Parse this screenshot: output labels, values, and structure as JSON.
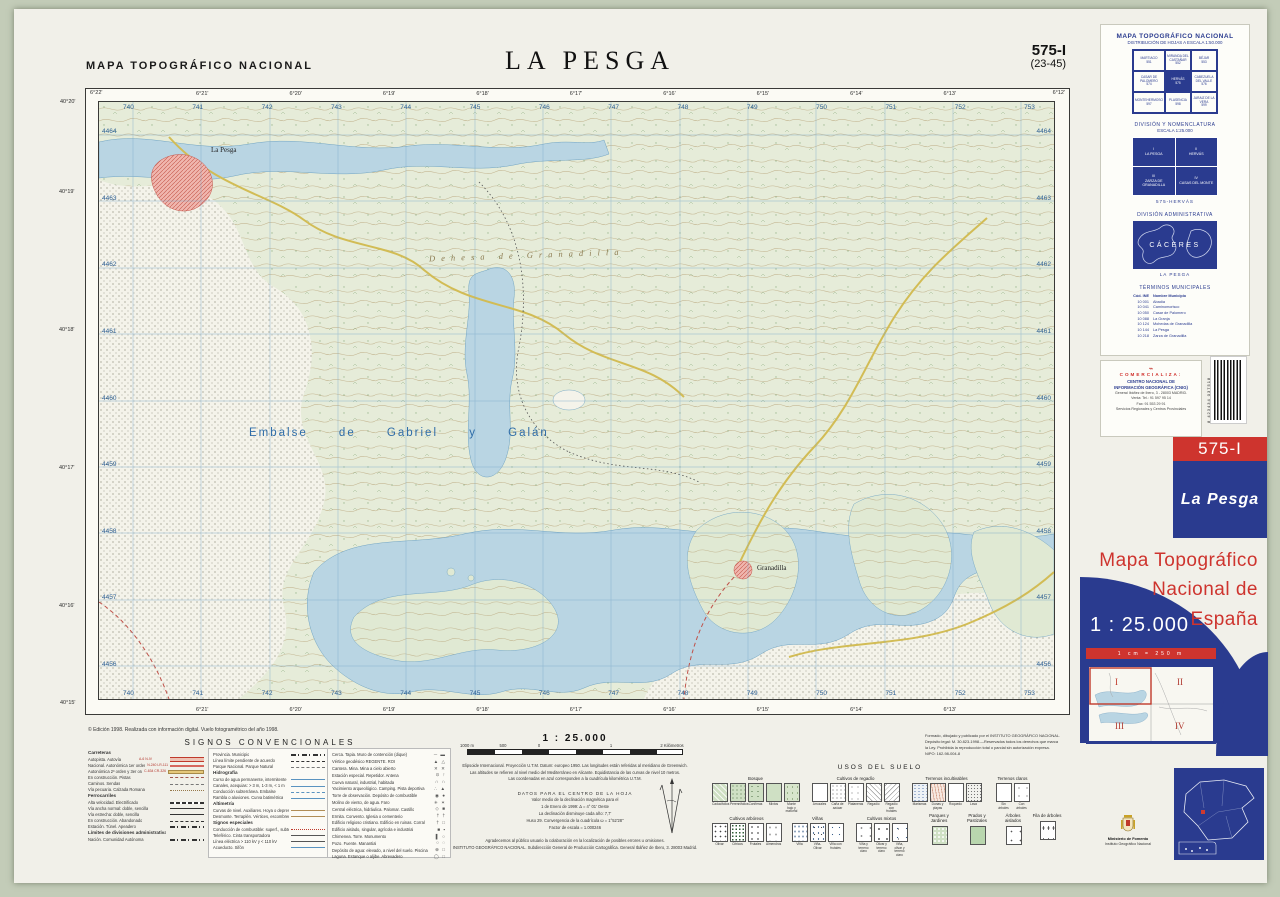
{
  "header": {
    "series": "MAPA TOPOGRÁFICO NACIONAL",
    "title": "LA PESGA",
    "sheet": "575-I",
    "subsheet": "(23-45)"
  },
  "map": {
    "labels": {
      "reservoir": "Embalse de Gabriel y Galán",
      "dehesa": "Dehesa de Granadilla",
      "town1": "La Pesga",
      "town2": "Granadilla"
    },
    "edges": {
      "eastings": [
        "740",
        "741",
        "742",
        "743",
        "744",
        "745",
        "746",
        "747",
        "748",
        "749",
        "750",
        "751",
        "752",
        "753"
      ],
      "northings": [
        "4464",
        "4463",
        "4462",
        "4461",
        "4460",
        "4459",
        "4458",
        "4457",
        "4456"
      ],
      "lon_ticks": [
        "6°21'",
        "6°20'",
        "6°19'",
        "6°18'",
        "6°17'",
        "6°16'",
        "6°15'",
        "6°14'",
        "6°13'"
      ],
      "lat_ticks": [
        "40°19'",
        "40°18'",
        "40°17'",
        "40°16'"
      ],
      "corner_lat_top": "40°20'",
      "corner_lat_bottom": "40°15'",
      "corner_lon_left": "6°22'",
      "corner_lon_right": "6°12'"
    }
  },
  "sidebar": {
    "dist": {
      "title": "MAPA TOPOGRÁFICO NACIONAL",
      "subtitle": "DISTRIBUCIÓN DE HOJAS A ESCALA 1:50.000",
      "cells": [
        {
          "name": "MARTIAGO",
          "num": "551"
        },
        {
          "name": "MIRANDA DEL CASTAÑAR",
          "num": "552"
        },
        {
          "name": "BÉJAR",
          "num": "553"
        },
        {
          "name": "CASAR DE PALOMERO",
          "num": "574"
        },
        {
          "name": "HERVÁS",
          "num": "575"
        },
        {
          "name": "CABEZUELA DEL VALLE",
          "num": "576"
        },
        {
          "name": "MONTEHERMOSO",
          "num": "597"
        },
        {
          "name": "PLASENCIA",
          "num": "598"
        },
        {
          "name": "JARAIZ DE LA VERA",
          "num": "599"
        }
      ]
    },
    "nomen": {
      "title": "DIVISIÓN Y NOMENCLATURA",
      "subtitle": "ESCALA 1:25.000",
      "cells": [
        {
          "rn": "I",
          "name": "LA PESGA"
        },
        {
          "rn": "II",
          "name": "HERVÁS"
        },
        {
          "rn": "III",
          "name": "ZARZA DE GRANADILLA"
        },
        {
          "rn": "IV",
          "name": "CASAS DEL MONTE"
        }
      ],
      "caption": "575-HERVÁS"
    },
    "admin": {
      "title": "DIVISIÓN ADMINISTRATIVA",
      "region": "CÁCERES",
      "caption": "LA PESGA"
    },
    "municipios": {
      "title": "TÉRMINOS MUNICIPALES",
      "header": {
        "c": "Cód. INE",
        "n": "Nombre Municipio"
      },
      "rows": [
        {
          "c": "10 001",
          "n": "Abadía"
        },
        {
          "c": "10 041",
          "n": "Caminomorisco"
        },
        {
          "c": "10 050",
          "n": "Casar de Palomero"
        },
        {
          "c": "10 088",
          "n": "La Granja"
        },
        {
          "c": "10 124",
          "n": "Mohedas de Granadilla"
        },
        {
          "c": "10 144",
          "n": "La Pesga"
        },
        {
          "c": "10 218",
          "n": "Zarza de Granadilla"
        }
      ]
    },
    "comercializa": {
      "label": "COMERCIALIZA:",
      "org1": "CENTRO NACIONAL DE",
      "org2": "INFORMACIÓN GEOGRÁFICA (CNIG)",
      "addr": "General Ibáñez de Ibero, 3 - 28003 MADRID.",
      "tel": "Venta: Tel.: 91 597 95 14",
      "fax": "Fax: 91 553 29 91",
      "services": "Servicios Regionales y Centros Provinciales"
    },
    "barcode": "8 423434 037518"
  },
  "cover": {
    "sheet": "575-I",
    "name": "La Pesga",
    "title1": "Mapa  Topográfico",
    "title2": "Nacional de",
    "title3": "España",
    "scale": "1 : 25.000",
    "bar": "1 cm = 250 m",
    "quads": [
      "I",
      "II",
      "III",
      "IV"
    ]
  },
  "ministry": {
    "l1": "Ministerio de Fomento",
    "l2": "Instituto Geográfico Nacional"
  },
  "legend": {
    "edition": "© Edición 1998. Realizada con información digital. Vuelo fotogramétrico del año 1998.",
    "title": "SIGNOS CONVENCIONALES",
    "c1": [
      {
        "t": "Carreteras",
        "rc": "lhdr",
        "sc": "sR"
      },
      {
        "t": "Autopista. Autovía",
        "bt": "A-6   N-IV",
        "sc": "sA"
      },
      {
        "t": "Nacional. Autonómica 1er orden",
        "bt": "N-240   LR-111",
        "sc": "sB"
      },
      {
        "t": "Autonómica 2º orden y 3er orden y otras",
        "bt": "C-634   CR-326",
        "sc": "sC"
      },
      {
        "t": "En construcción. Pistas",
        "sc": "sD"
      },
      {
        "t": "Caminos. Sendas",
        "sc": "sF"
      },
      {
        "t": "Vía pecuaria. Calzada Romana",
        "sc": "sG"
      },
      {
        "t": "Ferrocarriles",
        "rc": "lhdr",
        "sc": "sR"
      },
      {
        "t": "Alta velocidad. Electrificado",
        "sc": "sH"
      },
      {
        "t": "Vía ancha normal: doble, sencilla",
        "sc": "sI"
      },
      {
        "t": "Vía estrecha: doble, sencilla",
        "sc": "sI"
      },
      {
        "t": "En construcción. Abandonado",
        "sc": "sJ"
      },
      {
        "t": "Estación. Túnel. Apeadero",
        "sc": "sK"
      },
      {
        "t": "Límites de divisiones administrativas",
        "rc": "lhdr",
        "sc": "sR"
      },
      {
        "t": "Nación. Comunidad Autónoma",
        "sc": "sK"
      }
    ],
    "c2": [
      {
        "t": "Provincia. Municipio",
        "sc": "sK"
      },
      {
        "t": "Línea límite pendiente de acuerdo",
        "sc": "sJ"
      },
      {
        "t": "Parque Nacional. Parque Natural",
        "sc": "sF"
      },
      {
        "t": "Hidrografía",
        "rc": "lhdr",
        "sc": "sR"
      },
      {
        "t": "Curso de agua permanente, intermitente",
        "sc": "sL"
      },
      {
        "t": "Canales, acequias: > 3 m, 1-3 m, < 1 m",
        "sc": "sM"
      },
      {
        "t": "Conducción subterránea. Embalse",
        "sc": "sN"
      },
      {
        "t": "Rambla o aluviones. Curva batimétrica",
        "sc": "sL"
      },
      {
        "t": "Altimetría",
        "rc": "lhdr",
        "sc": "sR"
      },
      {
        "t": "Curvas de nivel. Auxiliares. Hoya o depresión",
        "sc": "sO"
      },
      {
        "t": "Desmonte. Terraplén. Vértices, escombrera",
        "sc": "sO"
      },
      {
        "t": "Signos especiales",
        "rc": "lhdr",
        "sc": "sR"
      },
      {
        "t": "Conducción de combustible: superf., subterr.",
        "sc": "sQ"
      },
      {
        "t": "Teleférico. Cinta transportadora",
        "sc": "sP"
      },
      {
        "t": "Línea eléctrica > 110 kV y < 110 kV",
        "sc": "sP"
      },
      {
        "t": "Acueducto. Sifón",
        "sc": "sL"
      }
    ],
    "c3": [
      {
        "t": "Cerca. Tapia. Muro de contención (dique)",
        "g": "─  ▬"
      },
      {
        "t": "Vértice geodésico REGENTE. ROI",
        "g": "▲  △"
      },
      {
        "t": "Cantera. Mina. Mina a cielo abierto",
        "g": "✕  ✕"
      },
      {
        "t": "Estación especial. Repetidor. Antena",
        "g": "⊙  ↑"
      },
      {
        "t": "Cueva natural, industrial, habitada",
        "g": "∩  ∩"
      },
      {
        "t": "Yacimiento arqueológico. Camping. Pista deportiva",
        "g": "∴  ▲"
      },
      {
        "t": "Torre de observación. Depósito de combustible",
        "g": "◉  ●"
      },
      {
        "t": "Molino de viento, de agua. Faro",
        "g": "✳  ✶"
      },
      {
        "t": "Central eléctrica, hidráulica. Palomar. Castillo",
        "g": "◇  ■"
      },
      {
        "t": "Ermita. Convento. Iglesia o cementerio",
        "g": "†  †"
      },
      {
        "t": "Edificio religioso cristiano. Edificio en ruinas. Corral",
        "g": "†  □"
      },
      {
        "t": "Edificio aislado, singular, agrícola e industrial",
        "g": "■  ▪"
      },
      {
        "t": "Chimenea. Torre. Monumento",
        "g": "▌  ○"
      },
      {
        "t": "Pozo. Fuente. Manantial",
        "g": "○  ◌"
      },
      {
        "t": "Depósito de agua: elevado, a nivel del suelo. Piscina",
        "g": "⊕  □"
      },
      {
        "t": "Laguna. Estanque o aljibe. Abrevadero",
        "g": "◯  □"
      }
    ]
  },
  "scaleblock": {
    "title": "1 : 25.000",
    "bar_labels": [
      "1000 m",
      "500",
      "0",
      "1",
      "2 Kilómetros"
    ],
    "proj": [
      "Elipsoide Internacional. Proyección U.T.M. Datum: europeo 1950. Las longitudes están referidas al meridiano de Greenwich.",
      "Las altitudes se refieren al nivel medio del Mediterráneo en Alicante. Equidistancia de las curvas de nivel 10 metros.",
      "Las coordenadas en azul corresponden a la cuadrícula kilométrica U.T.M."
    ],
    "datos": [
      "DATOS PARA EL CENTRO DE LA HOJA",
      "Valor medio de la declinación magnética para el",
      "1 de Enero de 1999:  Δ = 4° 01' Oeste",
      "La declinación disminuye cada año: 7,7'",
      "Huso 29. Convergencia de la cuadrícula ω = 1°52'28\"",
      "Factor de escala  =  1.000246"
    ],
    "ack": [
      "Agradecemos al público usuario la colaboración en la localización de posibles errores u omisiones.",
      "INSTITUTO GEOGRÁFICO NACIONAL. Subdirección General de Producción Cartográfica. General Ibáñez de Ibero, 3. 28003 Madrid."
    ]
  },
  "publisher": [
    "Formado, dibujado y publicado por el INSTITUTO GEOGRÁFICO NACIONAL.",
    "Depósito legal: M. 30.823-1998.—Reservados todos los derechos que marca",
    "la Ley. Prohibida la reproducción total o parcial sin autorización expresa.",
    "NIPO: 162-98-004-8"
  ],
  "usos": {
    "title": "USOS DEL SUELO",
    "groups": [
      {
        "title": "Bosque",
        "items": [
          {
            "label": "Caducifolios",
            "cls": "b1"
          },
          {
            "label": "Perennifolios",
            "cls": "b2"
          },
          {
            "label": "Coníferas",
            "cls": "b3"
          },
          {
            "label": "Mixtos",
            "cls": "b4"
          },
          {
            "label": "Monte bajo y matorral",
            "cls": "b5"
          }
        ]
      },
      {
        "title": "Cultivos de regadío",
        "items": [
          {
            "label": "Arrozales",
            "cls": "r1"
          },
          {
            "label": "Caña de azúcar",
            "cls": "r2"
          },
          {
            "label": "Plataneras",
            "cls": "r3"
          },
          {
            "label": "Regadío",
            "cls": "r4"
          },
          {
            "label": "Regadío con frutales",
            "cls": "r5"
          }
        ]
      },
      {
        "title": "Terrenos incultivables",
        "items": [
          {
            "label": "Marismas",
            "cls": "i1"
          },
          {
            "label": "Dunas y playas",
            "cls": "i2"
          },
          {
            "label": "Roquedo",
            "cls": "i3"
          },
          {
            "label": "Lava",
            "cls": "i4"
          }
        ]
      },
      {
        "title": "Terrenos claros",
        "items": [
          {
            "label": "Sin árboles",
            "cls": "c1"
          },
          {
            "label": "Con árboles",
            "cls": "c2"
          }
        ]
      },
      {
        "title": "Cultivos arbóreos",
        "items": [
          {
            "label": "Olivar",
            "cls": "a1"
          },
          {
            "label": "Cítricos",
            "cls": "a2"
          },
          {
            "label": "Frutales",
            "cls": "a3"
          },
          {
            "label": "Almendros",
            "cls": "a4"
          }
        ]
      },
      {
        "title": "Viñas",
        "items": [
          {
            "label": "Viña",
            "cls": "v1"
          },
          {
            "label": "Viña-Olivar",
            "cls": "v2"
          },
          {
            "label": "Viña con frutales",
            "cls": "v3"
          }
        ]
      },
      {
        "title": "Cultivos mixtos",
        "items": [
          {
            "label": "Viña y terreno claro",
            "cls": "m1"
          },
          {
            "label": "Olivar y terreno claro",
            "cls": "m2"
          },
          {
            "label": "Viña, olivar y terreno claro",
            "cls": "m3"
          }
        ]
      },
      {
        "title": "Parques y Jardines",
        "items": [
          {
            "label": "",
            "cls": "p1x"
          }
        ]
      },
      {
        "title": "Prados y Pastizales",
        "items": [
          {
            "label": "",
            "cls": "p2x"
          }
        ]
      },
      {
        "title": "Árboles aislados",
        "items": [
          {
            "label": "",
            "cls": "p3x"
          }
        ]
      },
      {
        "title": "Fila de árboles",
        "items": [
          {
            "label": "",
            "cls": "p4x"
          }
        ]
      }
    ]
  },
  "colors": {
    "ign_blue": "#2a3b8f",
    "ign_red": "#ce342e",
    "water": "#b9d5e3",
    "terrain": "#e6ecd9",
    "contour": "#b59a6b"
  }
}
